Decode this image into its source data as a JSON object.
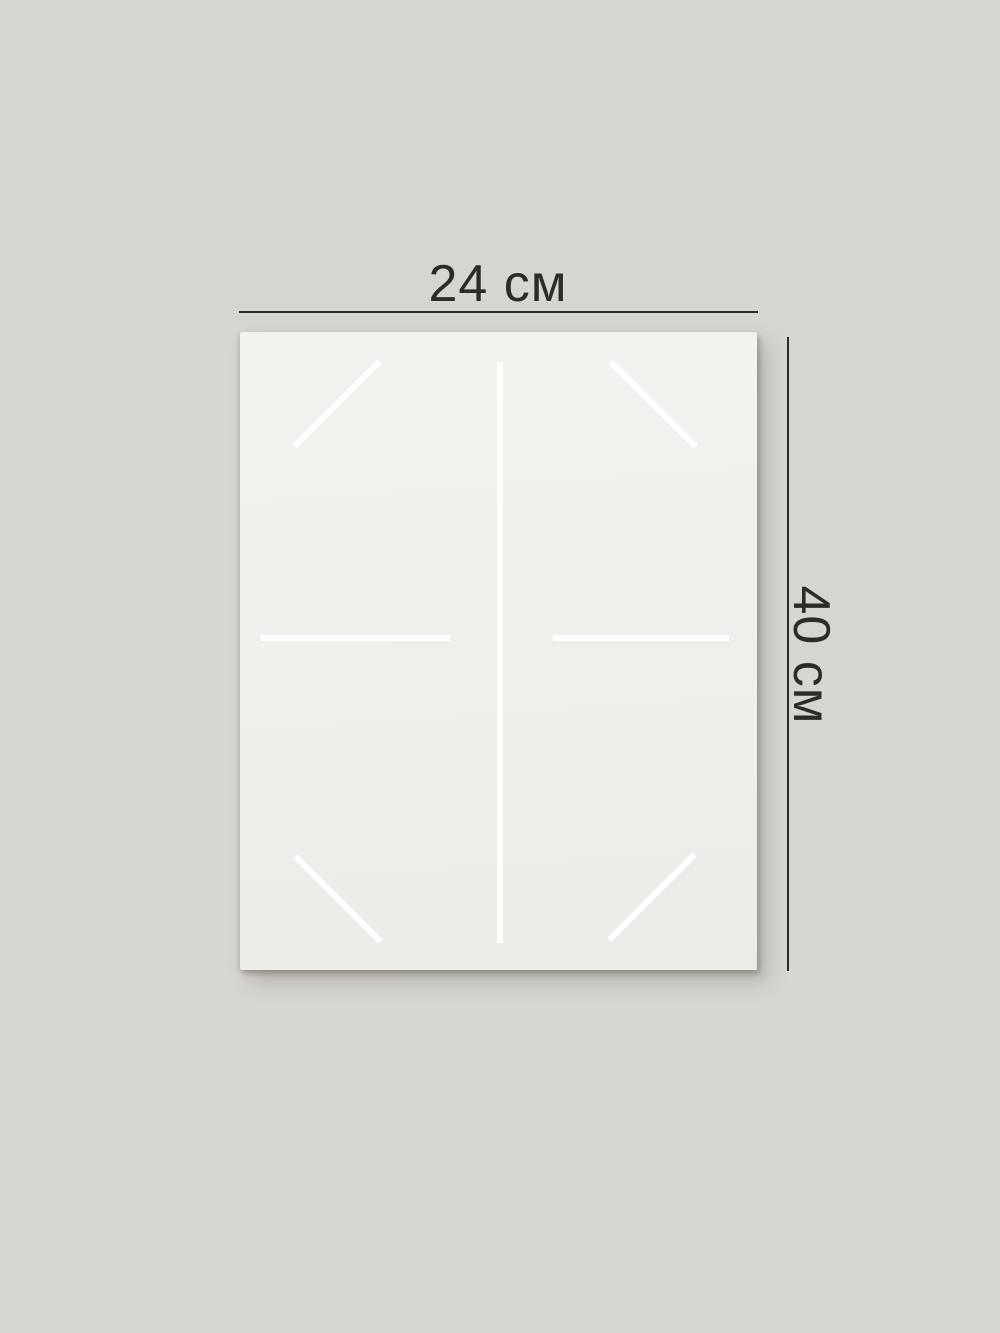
{
  "scene": {
    "description": "product dimension photo of a white board with white markings"
  },
  "colors": {
    "background": "#d7d5d1",
    "board": "#f0efeb",
    "board-top": "#f3f2ee",
    "board-bottom": "#ecebe7",
    "marking": "#ffffff",
    "dimension": "#2c2b28"
  },
  "dimensions": {
    "width_label": "24 см",
    "height_label": "40 см"
  }
}
